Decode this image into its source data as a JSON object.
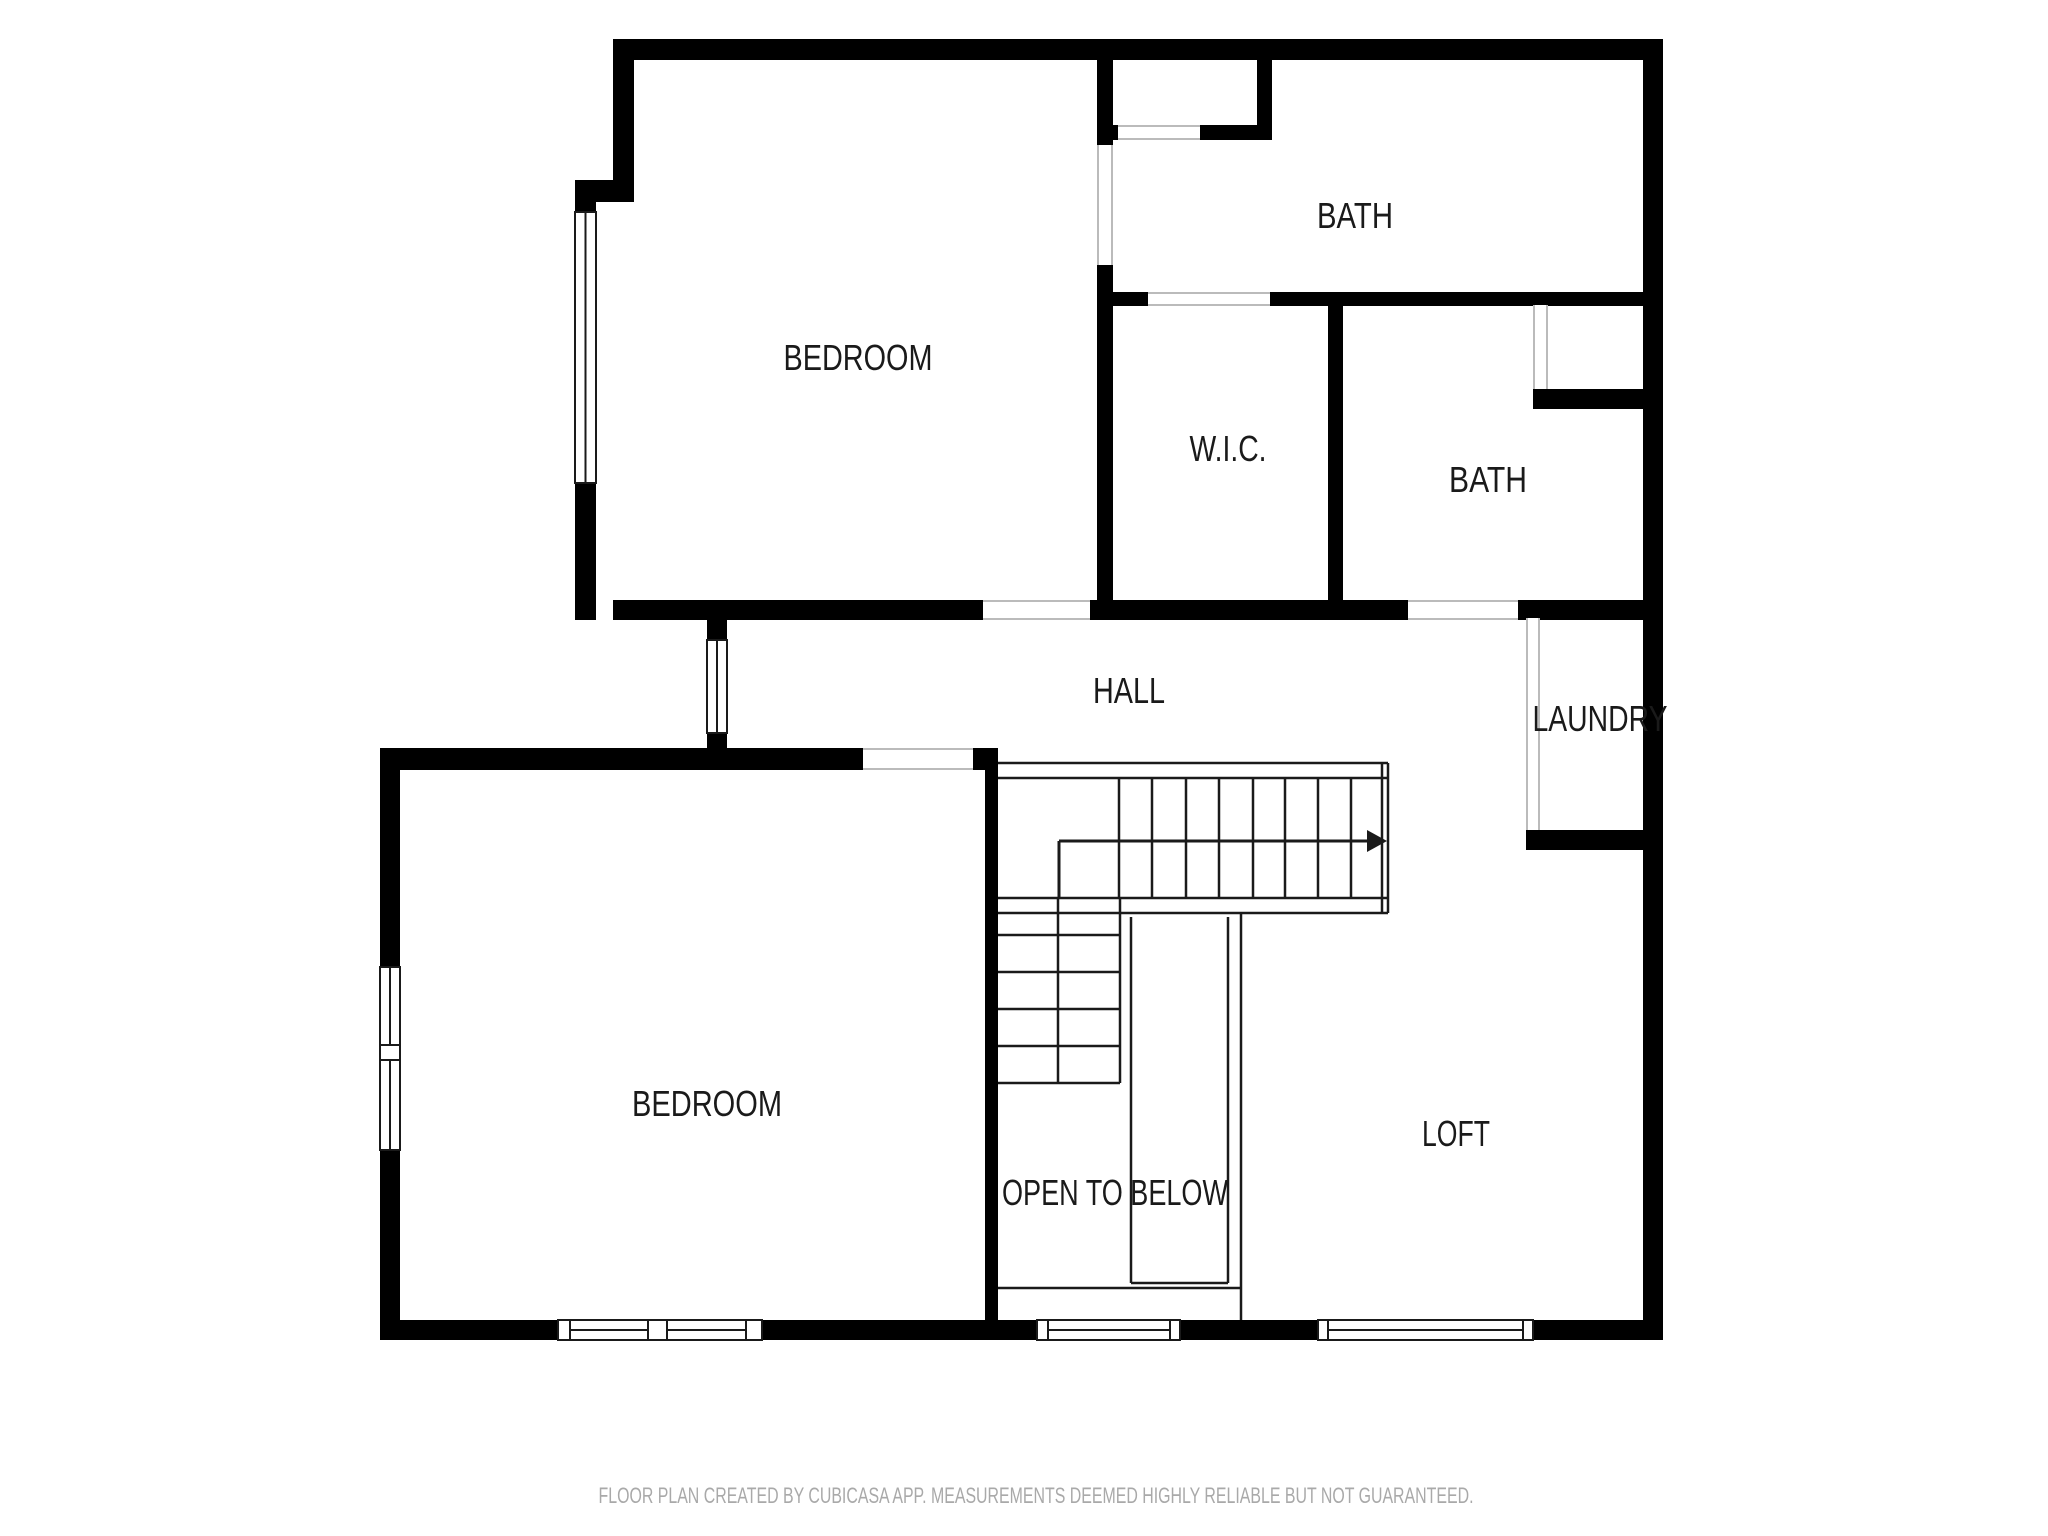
{
  "page": {
    "background": "#ffffff",
    "width": 2048,
    "height": 1536
  },
  "footer": {
    "text": "FLOOR PLAN CREATED BY CUBICASA APP. MEASUREMENTS DEEMED HIGHLY RELIABLE BUT NOT GUARANTEED.",
    "x": 1036,
    "y": 1503,
    "text_length": 875,
    "font_size": 22,
    "color": "#a9a9a9"
  },
  "rooms": [
    {
      "id": "bedroom-top",
      "label": "BEDROOM",
      "x": 858,
      "y": 370,
      "text_length": 149,
      "font_size": 36
    },
    {
      "id": "bath-top",
      "label": "BATH",
      "x": 1355,
      "y": 228,
      "text_length": 76,
      "font_size": 36
    },
    {
      "id": "wic",
      "label": "W.I.C.",
      "x": 1228,
      "y": 461,
      "text_length": 77,
      "font_size": 36
    },
    {
      "id": "bath-middle",
      "label": "BATH",
      "x": 1488,
      "y": 492,
      "text_length": 78,
      "font_size": 36
    },
    {
      "id": "hall",
      "label": "HALL",
      "x": 1129,
      "y": 703,
      "text_length": 72,
      "font_size": 36
    },
    {
      "id": "laundry",
      "label": "LAUNDRY",
      "x": 1600,
      "y": 731,
      "text_length": 135,
      "font_size": 36
    },
    {
      "id": "bedroom-bottom",
      "label": "BEDROOM",
      "x": 707,
      "y": 1116,
      "text_length": 150,
      "font_size": 36
    },
    {
      "id": "open-to-below",
      "label": "OPEN TO BELOW",
      "x": 1115,
      "y": 1205,
      "text_length": 226,
      "font_size": 36
    },
    {
      "id": "loft",
      "label": "LOFT",
      "x": 1456,
      "y": 1146,
      "text_length": 68,
      "font_size": 36
    }
  ],
  "plan": {
    "colors": {
      "wall": "#000000",
      "thin_line": "#1a1a1a",
      "door_edge": "#bbbbbb",
      "window_stroke": "#1a1a1a",
      "label": "#1a1a1a"
    },
    "walls": [
      {
        "x": 613,
        "y": 39,
        "w": 1050,
        "h": 21
      },
      {
        "x": 1643,
        "y": 39,
        "w": 20,
        "h": 1301
      },
      {
        "x": 380,
        "y": 1320,
        "w": 1283,
        "h": 20
      },
      {
        "x": 613,
        "y": 39,
        "w": 21,
        "h": 163
      },
      {
        "x": 575,
        "y": 180,
        "w": 59,
        "h": 22
      },
      {
        "x": 575,
        "y": 202,
        "w": 21,
        "h": 418
      },
      {
        "x": 613,
        "y": 600,
        "w": 1030,
        "h": 20
      },
      {
        "x": 707,
        "y": 620,
        "w": 20,
        "h": 128
      },
      {
        "x": 380,
        "y": 748,
        "w": 617,
        "h": 22
      },
      {
        "x": 380,
        "y": 748,
        "w": 20,
        "h": 592
      },
      {
        "x": 985,
        "y": 748,
        "w": 13,
        "h": 592
      },
      {
        "x": 1097,
        "y": 60,
        "w": 16,
        "h": 85
      },
      {
        "x": 1113,
        "y": 125,
        "w": 159,
        "h": 15
      },
      {
        "x": 1257,
        "y": 60,
        "w": 15,
        "h": 80
      },
      {
        "x": 1097,
        "y": 145,
        "w": 16,
        "h": 475
      },
      {
        "x": 1113,
        "y": 292,
        "w": 530,
        "h": 14
      },
      {
        "x": 1328,
        "y": 305,
        "w": 15,
        "h": 295
      },
      {
        "x": 1533,
        "y": 389,
        "w": 110,
        "h": 20
      },
      {
        "x": 1526,
        "y": 830,
        "w": 117,
        "h": 20
      }
    ],
    "door_gaps": [
      {
        "x": 983,
        "y": 600,
        "w": 107,
        "h": 20,
        "o": "h"
      },
      {
        "x": 1408,
        "y": 600,
        "w": 110,
        "h": 20,
        "o": "h"
      },
      {
        "x": 863,
        "y": 748,
        "w": 110,
        "h": 22,
        "o": "h"
      },
      {
        "x": 1148,
        "y": 292,
        "w": 122,
        "h": 14,
        "o": "h"
      },
      {
        "x": 1118,
        "y": 125,
        "w": 82,
        "h": 15,
        "o": "h"
      },
      {
        "x": 1097,
        "y": 145,
        "w": 16,
        "h": 120,
        "o": "v"
      },
      {
        "x": 1533,
        "y": 305,
        "w": 15,
        "h": 84,
        "o": "v"
      },
      {
        "x": 1526,
        "y": 618,
        "w": 14,
        "h": 212,
        "o": "v"
      }
    ],
    "windows": [
      {
        "x": 575,
        "y": 212,
        "w": 21,
        "h": 271,
        "o": "v"
      },
      {
        "x": 707,
        "y": 640,
        "w": 20,
        "h": 93,
        "o": "v"
      },
      {
        "x": 380,
        "y": 967,
        "w": 20,
        "h": 78,
        "o": "v"
      },
      {
        "x": 380,
        "y": 1060,
        "w": 20,
        "h": 90,
        "o": "v"
      },
      {
        "x": 570,
        "y": 1320,
        "w": 78,
        "h": 20,
        "o": "h"
      },
      {
        "x": 667,
        "y": 1320,
        "w": 79,
        "h": 20,
        "o": "h"
      },
      {
        "x": 1048,
        "y": 1320,
        "w": 122,
        "h": 20,
        "o": "h"
      },
      {
        "x": 1328,
        "y": 1320,
        "w": 195,
        "h": 20,
        "o": "h"
      }
    ],
    "window_posts": [
      {
        "x": 558,
        "y": 1320,
        "w": 12,
        "h": 20
      },
      {
        "x": 648,
        "y": 1320,
        "w": 19,
        "h": 20
      },
      {
        "x": 746,
        "y": 1320,
        "w": 16,
        "h": 20
      },
      {
        "x": 1037,
        "y": 1320,
        "w": 11,
        "h": 20
      },
      {
        "x": 1170,
        "y": 1320,
        "w": 10,
        "h": 20
      },
      {
        "x": 1318,
        "y": 1320,
        "w": 10,
        "h": 20
      },
      {
        "x": 1523,
        "y": 1320,
        "w": 10,
        "h": 20
      },
      {
        "x": 380,
        "y": 1045,
        "w": 20,
        "h": 15
      }
    ],
    "stair_lines": [
      {
        "x1": 998,
        "y1": 763,
        "x2": 1388,
        "y2": 763
      },
      {
        "x1": 1388,
        "y1": 763,
        "x2": 1388,
        "y2": 913
      },
      {
        "x1": 998,
        "y1": 913,
        "x2": 1388,
        "y2": 913
      },
      {
        "x1": 998,
        "y1": 778,
        "x2": 1388,
        "y2": 778
      },
      {
        "x1": 998,
        "y1": 898,
        "x2": 1388,
        "y2": 898
      },
      {
        "x1": 1382,
        "y1": 763,
        "x2": 1382,
        "y2": 913
      },
      {
        "x1": 1119,
        "y1": 778,
        "x2": 1119,
        "y2": 898
      },
      {
        "x1": 1152,
        "y1": 778,
        "x2": 1152,
        "y2": 898
      },
      {
        "x1": 1186,
        "y1": 778,
        "x2": 1186,
        "y2": 898
      },
      {
        "x1": 1219,
        "y1": 778,
        "x2": 1219,
        "y2": 898
      },
      {
        "x1": 1253,
        "y1": 778,
        "x2": 1253,
        "y2": 898
      },
      {
        "x1": 1285,
        "y1": 778,
        "x2": 1285,
        "y2": 898
      },
      {
        "x1": 1318,
        "y1": 778,
        "x2": 1318,
        "y2": 898
      },
      {
        "x1": 1351,
        "y1": 778,
        "x2": 1351,
        "y2": 898
      },
      {
        "x1": 1120,
        "y1": 898,
        "x2": 1120,
        "y2": 1083
      },
      {
        "x1": 998,
        "y1": 1083,
        "x2": 1120,
        "y2": 1083
      },
      {
        "x1": 1058,
        "y1": 898,
        "x2": 1058,
        "y2": 1083
      },
      {
        "x1": 998,
        "y1": 935,
        "x2": 1120,
        "y2": 935
      },
      {
        "x1": 998,
        "y1": 972,
        "x2": 1120,
        "y2": 972
      },
      {
        "x1": 998,
        "y1": 1009,
        "x2": 1120,
        "y2": 1009
      },
      {
        "x1": 998,
        "y1": 1046,
        "x2": 1120,
        "y2": 1046
      },
      {
        "x1": 1131,
        "y1": 917,
        "x2": 1131,
        "y2": 1283
      },
      {
        "x1": 1228,
        "y1": 917,
        "x2": 1228,
        "y2": 1283
      },
      {
        "x1": 1241,
        "y1": 913,
        "x2": 1241,
        "y2": 1320
      },
      {
        "x1": 1131,
        "y1": 1283,
        "x2": 1228,
        "y2": 1283
      },
      {
        "x1": 998,
        "y1": 1288,
        "x2": 1241,
        "y2": 1288
      }
    ],
    "stair_arrow": {
      "lines": [
        {
          "x1": 1059,
          "y1": 897,
          "x2": 1059,
          "y2": 841
        },
        {
          "x1": 1059,
          "y1": 841,
          "x2": 1367,
          "y2": 841
        }
      ],
      "head": "1367,830 1367,852 1387,841"
    }
  }
}
